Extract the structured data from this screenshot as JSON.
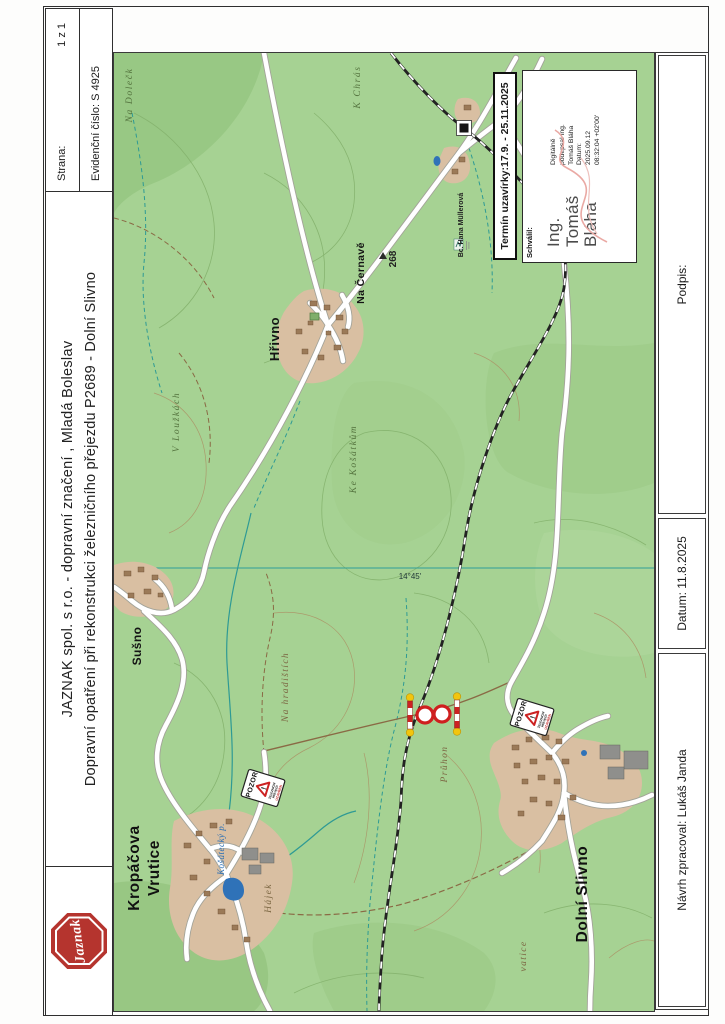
{
  "header": {
    "strana_label": "Strana:",
    "strana_value": "1 z 1",
    "evidencni": "Evidenční číslo: S 4925",
    "title_line1": "JAZNAK spol. s r.o. - dopravní značení , Mladá Boleslav",
    "title_line2": "Dopravní opatření při rekonstrukci železničního přejezdu P2689 - Dolní Slivno",
    "logo_text": "Jaznak"
  },
  "footer": {
    "podpis": "Podpis:",
    "datum": "Datum: 11.8.2025",
    "navrh": "Návrh zpracoval: Lukáš Janda"
  },
  "approval": {
    "termin": "Termín uzavírky:17.9. - 25.11.2025",
    "schvalil": "Schválil:",
    "signer_lines": [
      "Ing.",
      "Tomáš",
      "Bláha"
    ],
    "digital_lines": [
      "Digitálně",
      "podepsal Ing.",
      "Tomáš Bláha",
      "Datum:",
      "2025.09.12",
      "08:32:04 +02'00'"
    ]
  },
  "map": {
    "labels": {
      "hrivno": "Hřivno",
      "na_cernave": "Na Černavě",
      "elevation": "268",
      "surveyor": "Bc. Hana Müllerová",
      "na_doleck": "Na Dolečk",
      "k_chras": "K Chrás",
      "v_louzkach": "V Loužkách",
      "ke_kosatkum": "Ke Košátkům",
      "na_hradistich": "Na hradištích",
      "pruhon": "Průhon",
      "vatice": "vatice",
      "hajek": "Hájek",
      "kosatecky": "Košátecký p.",
      "susno": "Sušno",
      "kropacova_line1": "Kropáčova",
      "kropacova_line2": "Vrutice",
      "dolni_slivno": "Dolní Slivno",
      "meridian": "14°45'"
    },
    "warning_sign": {
      "pozor": "POZOR",
      "excl": "!",
      "line1": "ŽELEZNIČNÍ",
      "line2": "PŘEJEZD",
      "line3": "UZAVŘEN"
    },
    "colors": {
      "map_green": "#a6d293",
      "water_teal": "#2e9a94",
      "pond_blue": "#2f72b8",
      "sign_red": "#cc2222",
      "logo_red": "#b5342e",
      "village_tan": "#d9bfa2"
    }
  }
}
